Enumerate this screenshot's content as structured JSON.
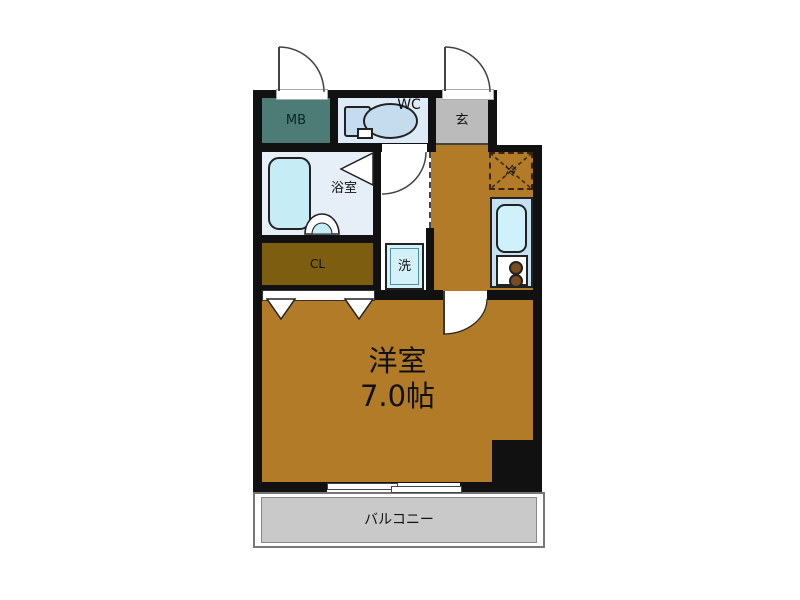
{
  "rooms": {
    "mb": {
      "label": "MB"
    },
    "wc": {
      "label": "WC"
    },
    "entrance": {
      "label": "玄"
    },
    "bathroom": {
      "label": "浴室"
    },
    "closet": {
      "label": "CL"
    },
    "laundry": {
      "label": "洗"
    },
    "refrigerator": {
      "label": "冷"
    },
    "western_room": {
      "label": "洋室",
      "area": "7.0帖"
    },
    "balcony": {
      "label": "バルコニー"
    }
  },
  "colors": {
    "wall": "#111111",
    "room_floor_brown": "#b17b28",
    "closet_floor": "#7d5e11",
    "mb_fill": "#4d7c77",
    "wc_fill": "#dcebf7",
    "entrance_fill": "#bbbbbb",
    "bathroom_fill": "#e6eef8",
    "fixture_blue": "#c6ecf5",
    "counter_blue": "#c5e1f2",
    "balcony_fill": "#c9c9c9",
    "background": "#ffffff"
  }
}
